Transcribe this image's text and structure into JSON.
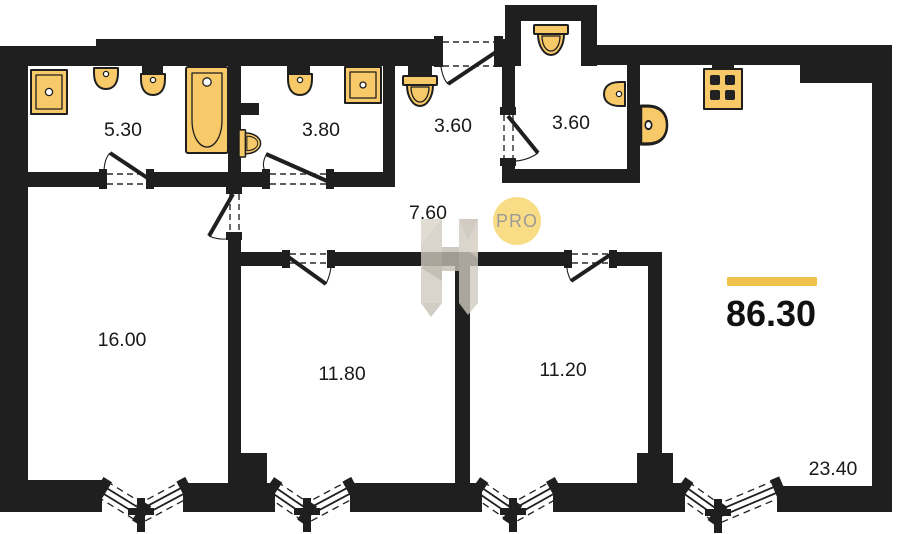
{
  "plan": {
    "background": "#ffffff",
    "wall_color": "#1f1f1f",
    "fixture_color": "#F8C968",
    "accent_color": "#EFC24B",
    "total_area": "86.30",
    "watermark": {
      "badge": "PRO",
      "badge_bg": "#F8DA7A",
      "badge_text_color": "#91908C",
      "logo_color": "#CCC6BB"
    },
    "rooms": [
      {
        "id": "bathroom",
        "label": "5.30"
      },
      {
        "id": "wc",
        "label": "3.80"
      },
      {
        "id": "entry-hall",
        "label": "3.60"
      },
      {
        "id": "bathroom-2",
        "label": "3.60"
      },
      {
        "id": "corridor",
        "label": "7.60"
      },
      {
        "id": "bedroom-1",
        "label": "16.00"
      },
      {
        "id": "bedroom-2",
        "label": "11.80"
      },
      {
        "id": "bedroom-3",
        "label": "11.20"
      },
      {
        "id": "kitchen-living-room",
        "label": "23.40"
      }
    ],
    "fixtures": [
      "washing-machine",
      "sink",
      "sink",
      "bathtub",
      "toilet",
      "sink",
      "sink-unit",
      "toilet",
      "toilet",
      "sink",
      "kitchen-sink",
      "stove"
    ],
    "doors": [
      "entrance-door",
      "bathroom-door",
      "wc-door",
      "bedroom-1-door",
      "bathroom-2-door",
      "bedroom-2-door",
      "bedroom-3-door"
    ],
    "bay_windows": 4
  }
}
